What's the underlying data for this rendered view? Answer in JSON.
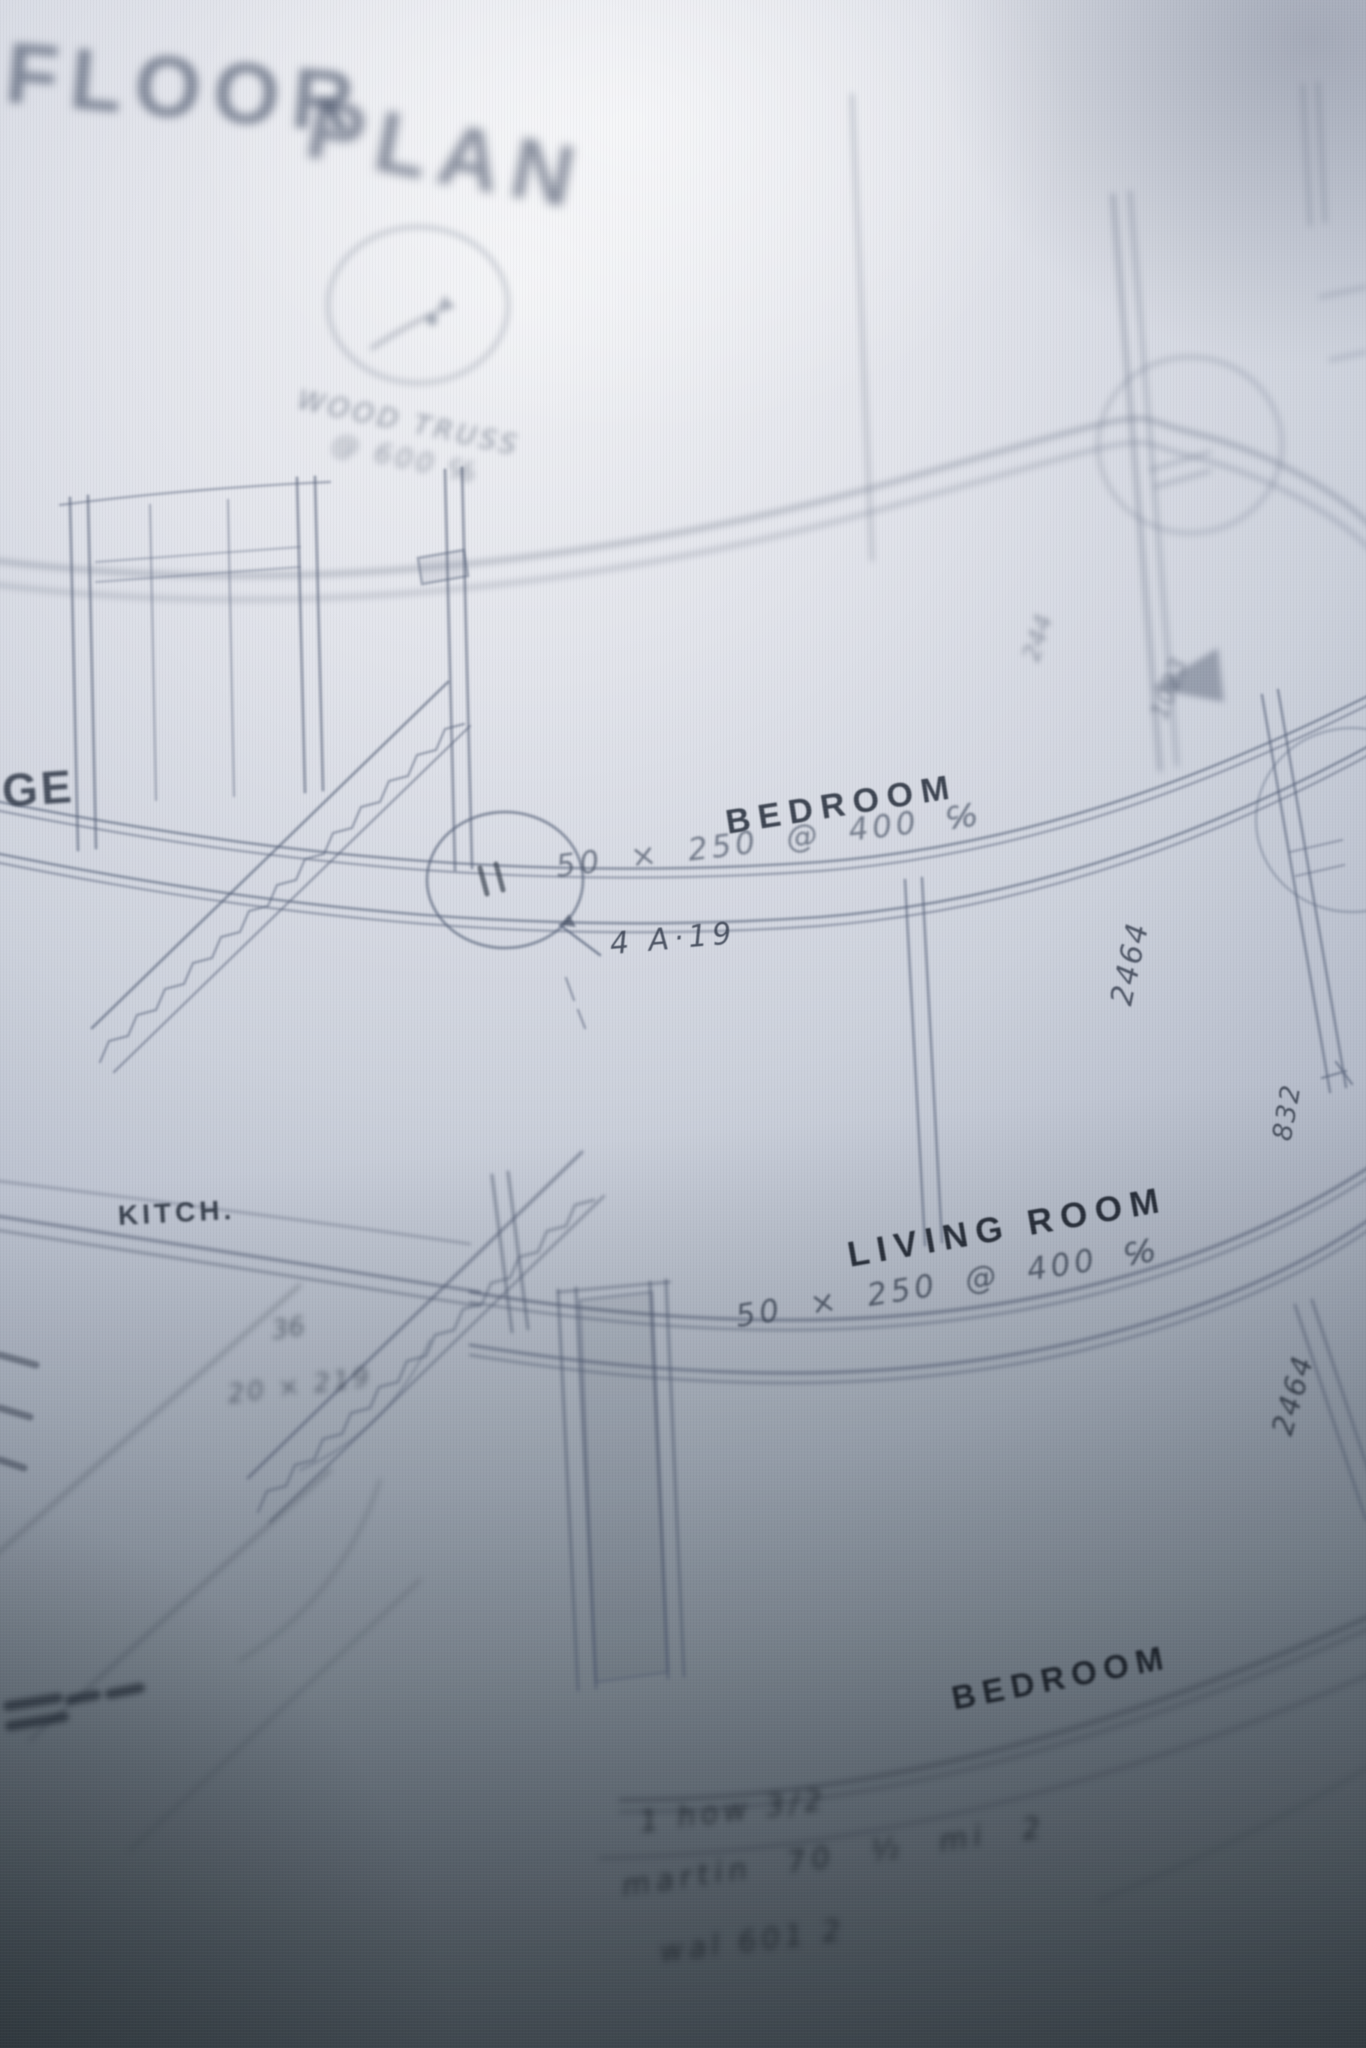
{
  "title": {
    "word1": "FLOOR",
    "word2": "PLAN"
  },
  "labels": {
    "bedroom_upper": "BEDROOM",
    "bedroom_upper_dim": "50 × 250 @ 400 ℅",
    "living_room": "LIVING ROOM",
    "living_room_dim": "50 × 250 @ 400 ℅",
    "bedroom_lower": "BEDROOM",
    "kitchen": "KITCH.",
    "room_edge_partial": "GE"
  },
  "annotations": {
    "detail_ref": "4 A·19",
    "truss_note_1": "WOOD TRUSS",
    "truss_note_2": "@ 600 ℅",
    "kitchen_note_1": "36",
    "kitchen_note_2": "20 × 219",
    "bottom_note_1": "1 how 3/2",
    "bottom_note_2": "martin 70 ½  mi 2",
    "bottom_note_3": "wal 601 2"
  },
  "dimensions": {
    "wall_upper": "2464",
    "wall_lower": "2464",
    "offset": "832",
    "top_a": "244",
    "top_b": "1023"
  },
  "colors": {
    "paper_light": "#f1f2f5",
    "paper_mid": "#c7ccd8",
    "paper_dark": "#59626f",
    "pencil": "#5f6a7e",
    "ink_dark": "#2b3340"
  }
}
